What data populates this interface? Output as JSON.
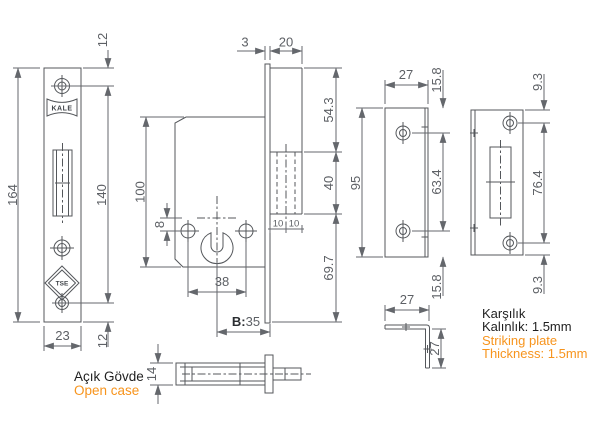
{
  "colors": {
    "line": "#54575b",
    "dim_text": "#5d6065",
    "text_black": "#1f1f1f",
    "accent_orange": "#f7941d",
    "background": "#ffffff"
  },
  "logos": {
    "brand": "KALE",
    "cert": "TSE"
  },
  "faceplate_front": {
    "offset_top": "12",
    "total_height": "164",
    "hole_span": "140",
    "width": "23",
    "offset_bottom": "12"
  },
  "body_side": {
    "faceplate_thickness": "3",
    "case_depth": "20",
    "upper_section": "54.3",
    "bolt_height": "40",
    "lower_section": "69.7",
    "body_height": "100",
    "cyl_hole_offset": "8",
    "screw_span": "38",
    "backset_label": "B:",
    "backset_value": "35",
    "bolt_half_left": "10",
    "bolt_half_right": "10"
  },
  "strike_flat": {
    "width": "27",
    "height": "95",
    "top": "15.8",
    "middle": "63.4",
    "bottom": "15.8"
  },
  "strike_angled": {
    "top": "9.3",
    "middle": "76.4",
    "bottom": "9.3"
  },
  "angle_bracket": {
    "leg_top": "27",
    "leg_side": "27"
  },
  "body_top_view": {
    "thickness": "14"
  },
  "captions": {
    "open_case_tr": "Açık Gövde",
    "open_case_en": "Open case",
    "strike_name_tr": "Karşılık",
    "strike_thickness_tr": "Kalınlık: 1.5mm",
    "strike_name_en": "Striking plate",
    "strike_thickness_en": "Thickness: 1.5mm"
  }
}
